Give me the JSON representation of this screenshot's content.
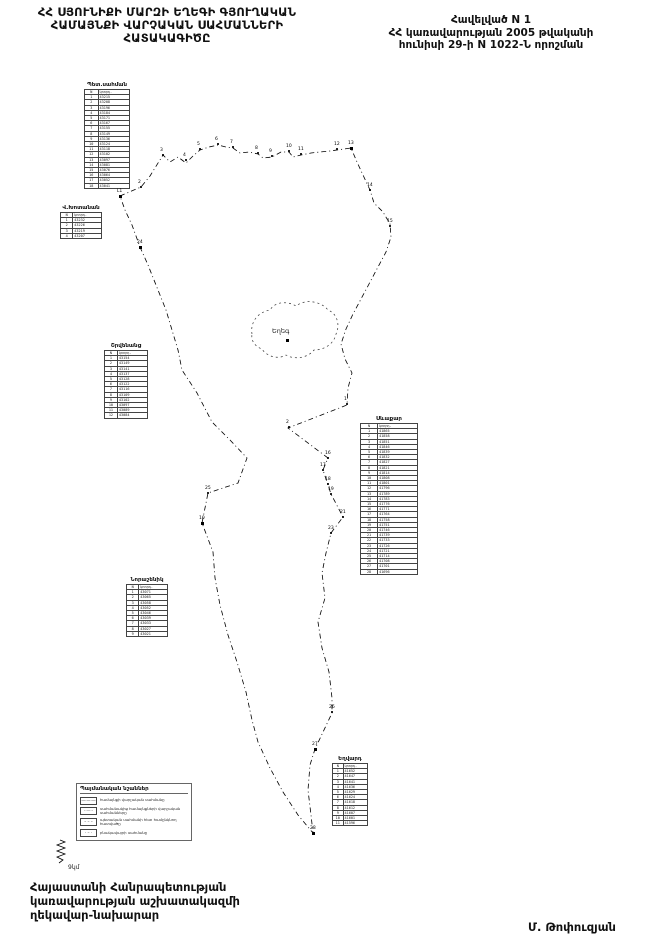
{
  "header": {
    "title_lines": [
      "ՀՀ ՍՅՈՒՆԻՔԻ ՄԱՐԶԻ ԵՂԵԳԻ ԳՅՈՒՂԱԿԱՆ",
      "ՀԱՄԱՅՆՔԻ  ՎԱՐՉԱԿԱՆ  ՍԱՀՄԱՆՆԵՐԻ",
      "ՀԱՏԱԿԱԳԻԾԸ"
    ],
    "appendix_lines": [
      "Հավելված N 1",
      "ՀՀ կառավարության 2005 թվականի",
      "հունիսի 29-ի N 1022-Ն որոշման"
    ]
  },
  "map": {
    "village_label": "Եղեգ",
    "scale_label": "9կմ",
    "neighbor_tables": [
      {
        "name": "Պետ.սահման",
        "x": 84,
        "y": 82,
        "w": 46,
        "rows": [
          [
            "N",
            "կոորդ."
          ],
          [
            "1",
            "43215"
          ],
          [
            "2",
            "43208"
          ],
          [
            "3",
            "43196"
          ],
          [
            "4",
            "43184"
          ],
          [
            "5",
            "43171"
          ],
          [
            "6",
            "43167"
          ],
          [
            "7",
            "43155"
          ],
          [
            "8",
            "43149"
          ],
          [
            "9",
            "43136"
          ],
          [
            "10",
            "43124"
          ],
          [
            "11",
            "43118"
          ],
          [
            "12",
            "43102"
          ],
          [
            "13",
            "43097"
          ],
          [
            "14",
            "43081"
          ],
          [
            "15",
            "43076"
          ],
          [
            "16",
            "43064"
          ],
          [
            "17",
            "43052"
          ],
          [
            "18",
            "43041"
          ]
        ]
      },
      {
        "name": "Վ.Խոտանան",
        "x": 60,
        "y": 205,
        "w": 42,
        "rows": [
          [
            "N",
            "կոորդ."
          ],
          [
            "1",
            "43232"
          ],
          [
            "2",
            "43226"
          ],
          [
            "3",
            "43219"
          ],
          [
            "4",
            "43207"
          ]
        ]
      },
      {
        "name": "Շրվենանց",
        "x": 104,
        "y": 343,
        "w": 44,
        "rows": [
          [
            "N",
            "կոորդ."
          ],
          [
            "1",
            "43154"
          ],
          [
            "2",
            "43149"
          ],
          [
            "3",
            "43141"
          ],
          [
            "4",
            "43137"
          ],
          [
            "5",
            "43128"
          ],
          [
            "6",
            "43122"
          ],
          [
            "7",
            "43116"
          ],
          [
            "8",
            "43109"
          ],
          [
            "9",
            "43102"
          ],
          [
            "10",
            "43097"
          ],
          [
            "11",
            "43089"
          ],
          [
            "12",
            "43084"
          ]
        ]
      },
      {
        "name": "Նորաշենիկ",
        "x": 126,
        "y": 577,
        "w": 42,
        "rows": [
          [
            "N",
            "կոորդ."
          ],
          [
            "1",
            "43071"
          ],
          [
            "2",
            "43065"
          ],
          [
            "3",
            "43058"
          ],
          [
            "4",
            "43052"
          ],
          [
            "5",
            "43046"
          ],
          [
            "6",
            "43039"
          ],
          [
            "7",
            "43033"
          ],
          [
            "8",
            "43027"
          ],
          [
            "9",
            "43021"
          ]
        ]
      },
      {
        "name": "Սևաքար",
        "x": 360,
        "y": 416,
        "w": 58,
        "rows": [
          [
            "N",
            "կոորդ."
          ],
          [
            "1",
            "41865"
          ],
          [
            "2",
            "41858"
          ],
          [
            "3",
            "41851"
          ],
          [
            "4",
            "41846"
          ],
          [
            "5",
            "41839"
          ],
          [
            "6",
            "41832"
          ],
          [
            "7",
            "41827"
          ],
          [
            "8",
            "41821"
          ],
          [
            "9",
            "41814"
          ],
          [
            "10",
            "41808"
          ],
          [
            "11",
            "41801"
          ],
          [
            "12",
            "41796"
          ],
          [
            "13",
            "41789"
          ],
          [
            "14",
            "41783"
          ],
          [
            "15",
            "41776"
          ],
          [
            "16",
            "41771"
          ],
          [
            "17",
            "41764"
          ],
          [
            "18",
            "41758"
          ],
          [
            "19",
            "41751"
          ],
          [
            "20",
            "41746"
          ],
          [
            "21",
            "41739"
          ],
          [
            "22",
            "41733"
          ],
          [
            "23",
            "41726"
          ],
          [
            "24",
            "41721"
          ],
          [
            "25",
            "41714"
          ],
          [
            "26",
            "41708"
          ],
          [
            "27",
            "41701"
          ],
          [
            "28",
            "41696"
          ]
        ]
      },
      {
        "name": "Եղվարդ",
        "x": 332,
        "y": 756,
        "w": 36,
        "rows": [
          [
            "N",
            "կոորդ."
          ],
          [
            "1",
            "41652"
          ],
          [
            "2",
            "41647"
          ],
          [
            "3",
            "41641"
          ],
          [
            "4",
            "41636"
          ],
          [
            "5",
            "41629"
          ],
          [
            "6",
            "41624"
          ],
          [
            "7",
            "41618"
          ],
          [
            "8",
            "41612"
          ],
          [
            "9",
            "41607"
          ],
          [
            "10",
            "41601"
          ],
          [
            "11",
            "41596"
          ]
        ]
      }
    ],
    "points": [
      {
        "x": 120,
        "y": 196,
        "t": "Լ1",
        "sq": true
      },
      {
        "x": 141,
        "y": 187,
        "t": "2"
      },
      {
        "x": 163,
        "y": 155,
        "t": "3"
      },
      {
        "x": 186,
        "y": 160,
        "t": "4"
      },
      {
        "x": 200,
        "y": 149,
        "t": "5"
      },
      {
        "x": 218,
        "y": 144,
        "t": "6"
      },
      {
        "x": 233,
        "y": 147,
        "t": "7"
      },
      {
        "x": 258,
        "y": 153,
        "t": "8"
      },
      {
        "x": 272,
        "y": 156,
        "t": "9"
      },
      {
        "x": 289,
        "y": 151,
        "t": "10"
      },
      {
        "x": 301,
        "y": 154,
        "t": "11"
      },
      {
        "x": 337,
        "y": 149,
        "t": "12"
      },
      {
        "x": 351,
        "y": 148,
        "t": "13",
        "sq": true
      },
      {
        "x": 370,
        "y": 190,
        "t": "14"
      },
      {
        "x": 390,
        "y": 226,
        "t": "15"
      },
      {
        "x": 347,
        "y": 404,
        "t": "1"
      },
      {
        "x": 289,
        "y": 427,
        "t": "2"
      },
      {
        "x": 328,
        "y": 458,
        "t": "16"
      },
      {
        "x": 323,
        "y": 470,
        "t": "17"
      },
      {
        "x": 328,
        "y": 484,
        "t": "18"
      },
      {
        "x": 331,
        "y": 494,
        "t": "19"
      },
      {
        "x": 343,
        "y": 517,
        "t": "21"
      },
      {
        "x": 331,
        "y": 533,
        "t": "23"
      },
      {
        "x": 140,
        "y": 247,
        "t": "24",
        "sq": true
      },
      {
        "x": 208,
        "y": 493,
        "t": "25"
      },
      {
        "x": 202,
        "y": 523,
        "t": "10",
        "sq": true
      },
      {
        "x": 332,
        "y": 712,
        "t": "26"
      },
      {
        "x": 315,
        "y": 749,
        "t": "27",
        "sq": true
      },
      {
        "x": 313,
        "y": 833,
        "t": "28",
        "sq": true
      }
    ]
  },
  "legend": {
    "title": "Պայմանական նշաններ",
    "items": [
      {
        "symbol": "—·—·—",
        "label": "համայնքի վարչական սահմանը"
      },
      {
        "symbol": "·······",
        "label": "սահմանակից համայնքների վարչական սահմանները"
      },
      {
        "symbol": "– – –",
        "label": "պետական սահմանի հետ համընկնող հատվածը"
      },
      {
        "symbol": "· – ·",
        "label": "բնակավայրի սահմանը"
      }
    ]
  },
  "footer": {
    "lines": [
      "Հայաստանի Հանրապետության",
      "կառավարության աշխատակազմի",
      "ղեկավար-նախարար"
    ],
    "signature": "Մ. Թոփուզյան"
  }
}
